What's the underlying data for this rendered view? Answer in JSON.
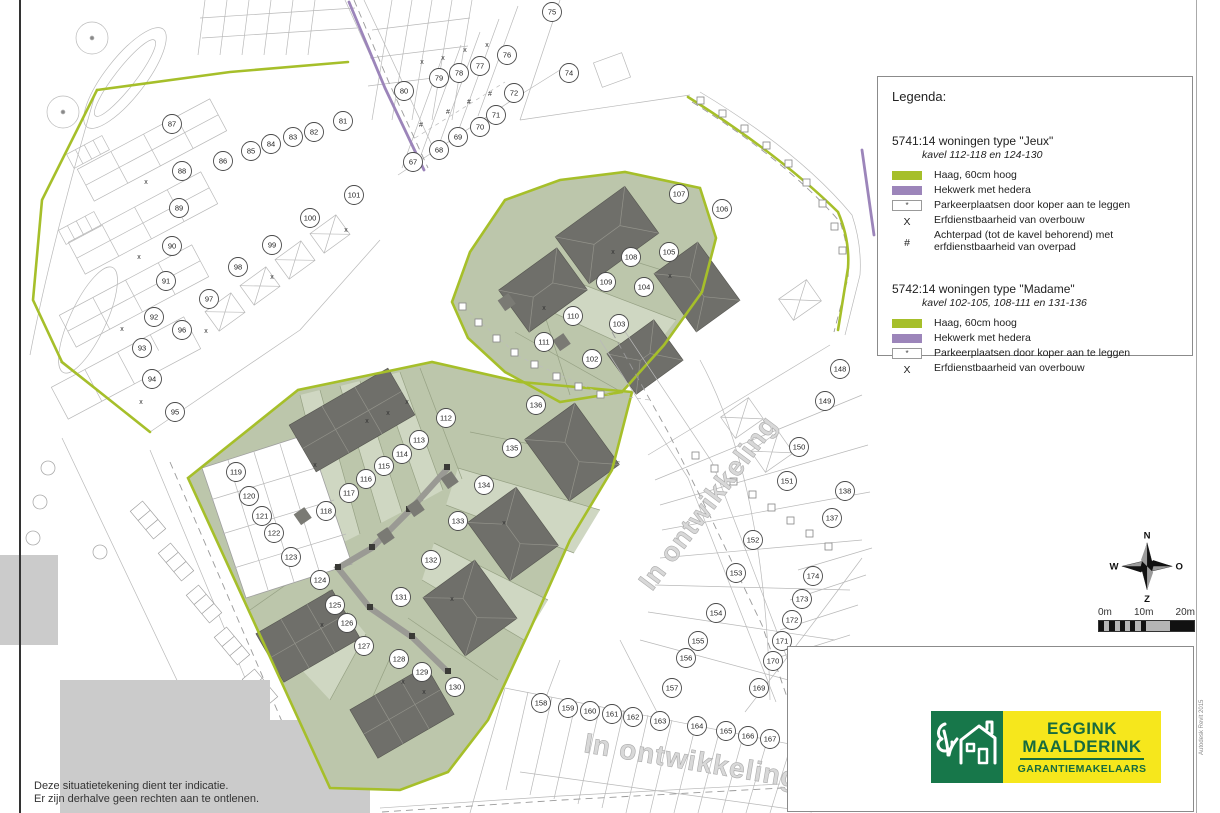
{
  "map": {
    "in_ontwikkeling_right": "In ontwikkeling",
    "in_ontwikkeling_bottom": "In ontwikkeling",
    "plots": [
      {
        "n": "67",
        "x": 413,
        "y": 162
      },
      {
        "n": "68",
        "x": 439,
        "y": 150
      },
      {
        "n": "69",
        "x": 458,
        "y": 137
      },
      {
        "n": "70",
        "x": 480,
        "y": 127
      },
      {
        "n": "71",
        "x": 496,
        "y": 115
      },
      {
        "n": "72",
        "x": 514,
        "y": 93
      },
      {
        "n": "74",
        "x": 569,
        "y": 73
      },
      {
        "n": "75",
        "x": 552,
        "y": 12
      },
      {
        "n": "76",
        "x": 507,
        "y": 55
      },
      {
        "n": "77",
        "x": 480,
        "y": 66
      },
      {
        "n": "78",
        "x": 459,
        "y": 73
      },
      {
        "n": "79",
        "x": 439,
        "y": 78
      },
      {
        "n": "80",
        "x": 404,
        "y": 91
      },
      {
        "n": "81",
        "x": 343,
        "y": 121
      },
      {
        "n": "82",
        "x": 314,
        "y": 132
      },
      {
        "n": "83",
        "x": 293,
        "y": 137
      },
      {
        "n": "84",
        "x": 271,
        "y": 144
      },
      {
        "n": "85",
        "x": 251,
        "y": 151
      },
      {
        "n": "86",
        "x": 223,
        "y": 161
      },
      {
        "n": "87",
        "x": 172,
        "y": 124
      },
      {
        "n": "88",
        "x": 182,
        "y": 171
      },
      {
        "n": "89",
        "x": 179,
        "y": 208
      },
      {
        "n": "90",
        "x": 172,
        "y": 246
      },
      {
        "n": "91",
        "x": 166,
        "y": 281
      },
      {
        "n": "92",
        "x": 154,
        "y": 317
      },
      {
        "n": "93",
        "x": 142,
        "y": 348
      },
      {
        "n": "94",
        "x": 152,
        "y": 379
      },
      {
        "n": "95",
        "x": 175,
        "y": 412
      },
      {
        "n": "96",
        "x": 182,
        "y": 330
      },
      {
        "n": "97",
        "x": 209,
        "y": 299
      },
      {
        "n": "98",
        "x": 238,
        "y": 267
      },
      {
        "n": "99",
        "x": 272,
        "y": 245
      },
      {
        "n": "100",
        "x": 310,
        "y": 218
      },
      {
        "n": "101",
        "x": 354,
        "y": 195
      },
      {
        "n": "102",
        "x": 592,
        "y": 359
      },
      {
        "n": "103",
        "x": 619,
        "y": 324
      },
      {
        "n": "104",
        "x": 644,
        "y": 287
      },
      {
        "n": "105",
        "x": 669,
        "y": 252
      },
      {
        "n": "106",
        "x": 722,
        "y": 209
      },
      {
        "n": "107",
        "x": 679,
        "y": 194
      },
      {
        "n": "108",
        "x": 631,
        "y": 257
      },
      {
        "n": "109",
        "x": 606,
        "y": 282
      },
      {
        "n": "110",
        "x": 573,
        "y": 316
      },
      {
        "n": "111",
        "x": 544,
        "y": 342
      },
      {
        "n": "112",
        "x": 446,
        "y": 418
      },
      {
        "n": "113",
        "x": 419,
        "y": 440
      },
      {
        "n": "114",
        "x": 402,
        "y": 454
      },
      {
        "n": "115",
        "x": 384,
        "y": 466
      },
      {
        "n": "116",
        "x": 366,
        "y": 479
      },
      {
        "n": "117",
        "x": 349,
        "y": 493
      },
      {
        "n": "118",
        "x": 326,
        "y": 511
      },
      {
        "n": "119",
        "x": 236,
        "y": 472
      },
      {
        "n": "120",
        "x": 249,
        "y": 496
      },
      {
        "n": "121",
        "x": 262,
        "y": 516
      },
      {
        "n": "122",
        "x": 274,
        "y": 533
      },
      {
        "n": "123",
        "x": 291,
        "y": 557
      },
      {
        "n": "124",
        "x": 320,
        "y": 580
      },
      {
        "n": "125",
        "x": 335,
        "y": 605
      },
      {
        "n": "126",
        "x": 347,
        "y": 623
      },
      {
        "n": "127",
        "x": 364,
        "y": 646
      },
      {
        "n": "128",
        "x": 399,
        "y": 659
      },
      {
        "n": "129",
        "x": 422,
        "y": 672
      },
      {
        "n": "130",
        "x": 455,
        "y": 687
      },
      {
        "n": "131",
        "x": 401,
        "y": 597
      },
      {
        "n": "132",
        "x": 431,
        "y": 560
      },
      {
        "n": "133",
        "x": 458,
        "y": 521
      },
      {
        "n": "134",
        "x": 484,
        "y": 485
      },
      {
        "n": "135",
        "x": 512,
        "y": 448
      },
      {
        "n": "136",
        "x": 536,
        "y": 405
      },
      {
        "n": "137",
        "x": 832,
        "y": 518
      },
      {
        "n": "138",
        "x": 845,
        "y": 491
      },
      {
        "n": "148",
        "x": 840,
        "y": 369
      },
      {
        "n": "149",
        "x": 825,
        "y": 401
      },
      {
        "n": "150",
        "x": 799,
        "y": 447
      },
      {
        "n": "151",
        "x": 787,
        "y": 481
      },
      {
        "n": "152",
        "x": 753,
        "y": 540
      },
      {
        "n": "153",
        "x": 736,
        "y": 573
      },
      {
        "n": "154",
        "x": 716,
        "y": 613
      },
      {
        "n": "155",
        "x": 698,
        "y": 641
      },
      {
        "n": "156",
        "x": 686,
        "y": 658
      },
      {
        "n": "157",
        "x": 672,
        "y": 688
      },
      {
        "n": "158",
        "x": 541,
        "y": 703
      },
      {
        "n": "159",
        "x": 568,
        "y": 708
      },
      {
        "n": "160",
        "x": 590,
        "y": 711
      },
      {
        "n": "161",
        "x": 612,
        "y": 714
      },
      {
        "n": "162",
        "x": 633,
        "y": 717
      },
      {
        "n": "163",
        "x": 660,
        "y": 721
      },
      {
        "n": "164",
        "x": 697,
        "y": 726
      },
      {
        "n": "165",
        "x": 726,
        "y": 731
      },
      {
        "n": "166",
        "x": 748,
        "y": 736
      },
      {
        "n": "167",
        "x": 770,
        "y": 739
      },
      {
        "n": "169",
        "x": 759,
        "y": 688
      },
      {
        "n": "170",
        "x": 773,
        "y": 661
      },
      {
        "n": "171",
        "x": 782,
        "y": 641
      },
      {
        "n": "172",
        "x": 792,
        "y": 620
      },
      {
        "n": "173",
        "x": 802,
        "y": 599
      },
      {
        "n": "174",
        "x": 813,
        "y": 576
      }
    ],
    "x_marks": {
      "symbol": "x",
      "points": [
        {
          "x": 146,
          "y": 184
        },
        {
          "x": 139,
          "y": 259
        },
        {
          "x": 122,
          "y": 331
        },
        {
          "x": 141,
          "y": 404
        },
        {
          "x": 206,
          "y": 333
        },
        {
          "x": 272,
          "y": 279
        },
        {
          "x": 346,
          "y": 232
        },
        {
          "x": 422,
          "y": 64
        },
        {
          "x": 443,
          "y": 60
        },
        {
          "x": 465,
          "y": 52
        },
        {
          "x": 487,
          "y": 47
        },
        {
          "x": 315,
          "y": 467
        },
        {
          "x": 367,
          "y": 423
        },
        {
          "x": 388,
          "y": 415
        },
        {
          "x": 407,
          "y": 404
        },
        {
          "x": 613,
          "y": 254
        },
        {
          "x": 544,
          "y": 310
        },
        {
          "x": 670,
          "y": 278
        },
        {
          "x": 504,
          "y": 525
        },
        {
          "x": 452,
          "y": 601
        },
        {
          "x": 322,
          "y": 627
        },
        {
          "x": 403,
          "y": 684
        },
        {
          "x": 424,
          "y": 694
        }
      ]
    },
    "hash_marks": {
      "symbol": "#",
      "points": [
        {
          "x": 421,
          "y": 127
        },
        {
          "x": 448,
          "y": 114
        },
        {
          "x": 469,
          "y": 104
        },
        {
          "x": 490,
          "y": 96
        }
      ]
    }
  },
  "legend": {
    "title": "Legenda:",
    "sections": [
      {
        "title": "5741:14 woningen type \"Jeux\"",
        "subtitle": "kavel 112-118 en 124-130",
        "items": [
          {
            "swatch": "green",
            "label": "Haag, 60cm hoog"
          },
          {
            "swatch": "purple",
            "label": "Hekwerk met hedera"
          },
          {
            "swatch": "parking",
            "symbol": "*",
            "label": "Parkeerplaatsen door koper aan te leggen"
          },
          {
            "swatch": "symbol",
            "symbol": "X",
            "label": "Erfdienstbaarheid van overbouw"
          },
          {
            "swatch": "symbol",
            "symbol": "#",
            "label": "Achterpad (tot de kavel behorend) met erfdienstbaarheid van overpad"
          }
        ]
      },
      {
        "title": "5742:14 woningen type \"Madame\"",
        "subtitle": "kavel 102-105, 108-111 en 131-136",
        "items": [
          {
            "swatch": "green",
            "label": "Haag, 60cm hoog"
          },
          {
            "swatch": "purple",
            "label": "Hekwerk met hedera"
          },
          {
            "swatch": "parking",
            "symbol": "*",
            "label": "Parkeerplaatsen door koper aan te leggen"
          },
          {
            "swatch": "symbol",
            "symbol": "X",
            "label": "Erfdienstbaarheid van overbouw"
          }
        ]
      }
    ]
  },
  "compass": {
    "north": "N",
    "east": "O",
    "south": "Z",
    "west": "W"
  },
  "scalebar": {
    "labels": [
      "0m",
      "10m",
      "20m"
    ]
  },
  "logo": {
    "line1": "EGGINK",
    "line2": "MAALDERINK",
    "line3": "GARANTIEMAKELAARS"
  },
  "disclaimer": {
    "line1": "Deze situatietekening dient ter indicatie.",
    "line2": "Er zijn derhalve geen rechten aan te ontlenen."
  },
  "stamp": "Autodesk Revit 2015",
  "colors": {
    "hedge": "#a6bf2a",
    "fence": "#9c85ba",
    "green_area": "#bcc6ab",
    "green_strip": "#cfd7c2",
    "building": "#6f6f6a",
    "logo_green": "#17774a",
    "logo_yellow": "#f6e71c",
    "logo_text": "#176b3e"
  }
}
